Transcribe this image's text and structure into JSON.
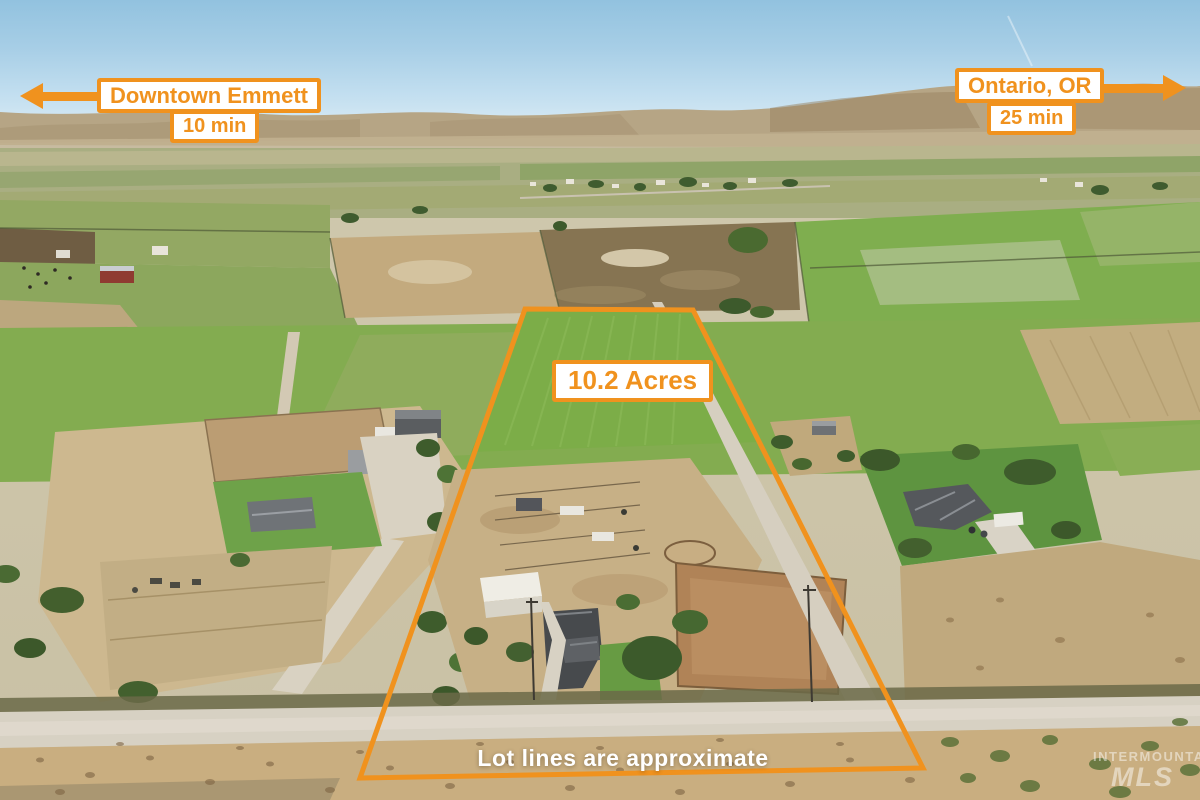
{
  "annotations": {
    "left_destination": {
      "name": "Downtown Emmett",
      "time": "10 min",
      "direction": "left"
    },
    "right_destination": {
      "name": "Ontario, OR",
      "time": "25 min",
      "direction": "right"
    },
    "acreage_label": "10.2 Acres",
    "disclaimer": "Lot lines are approximate"
  },
  "lot_outline": {
    "points": "525,309 693,310 923,768 360,778"
  },
  "watermark": {
    "line1": "INTERMOUNTAIN",
    "line2": "MLS"
  },
  "colors": {
    "accent_orange": "#F0921E",
    "label_background": "#FFFFFF",
    "disclaimer_text": "#FFFFFF"
  }
}
